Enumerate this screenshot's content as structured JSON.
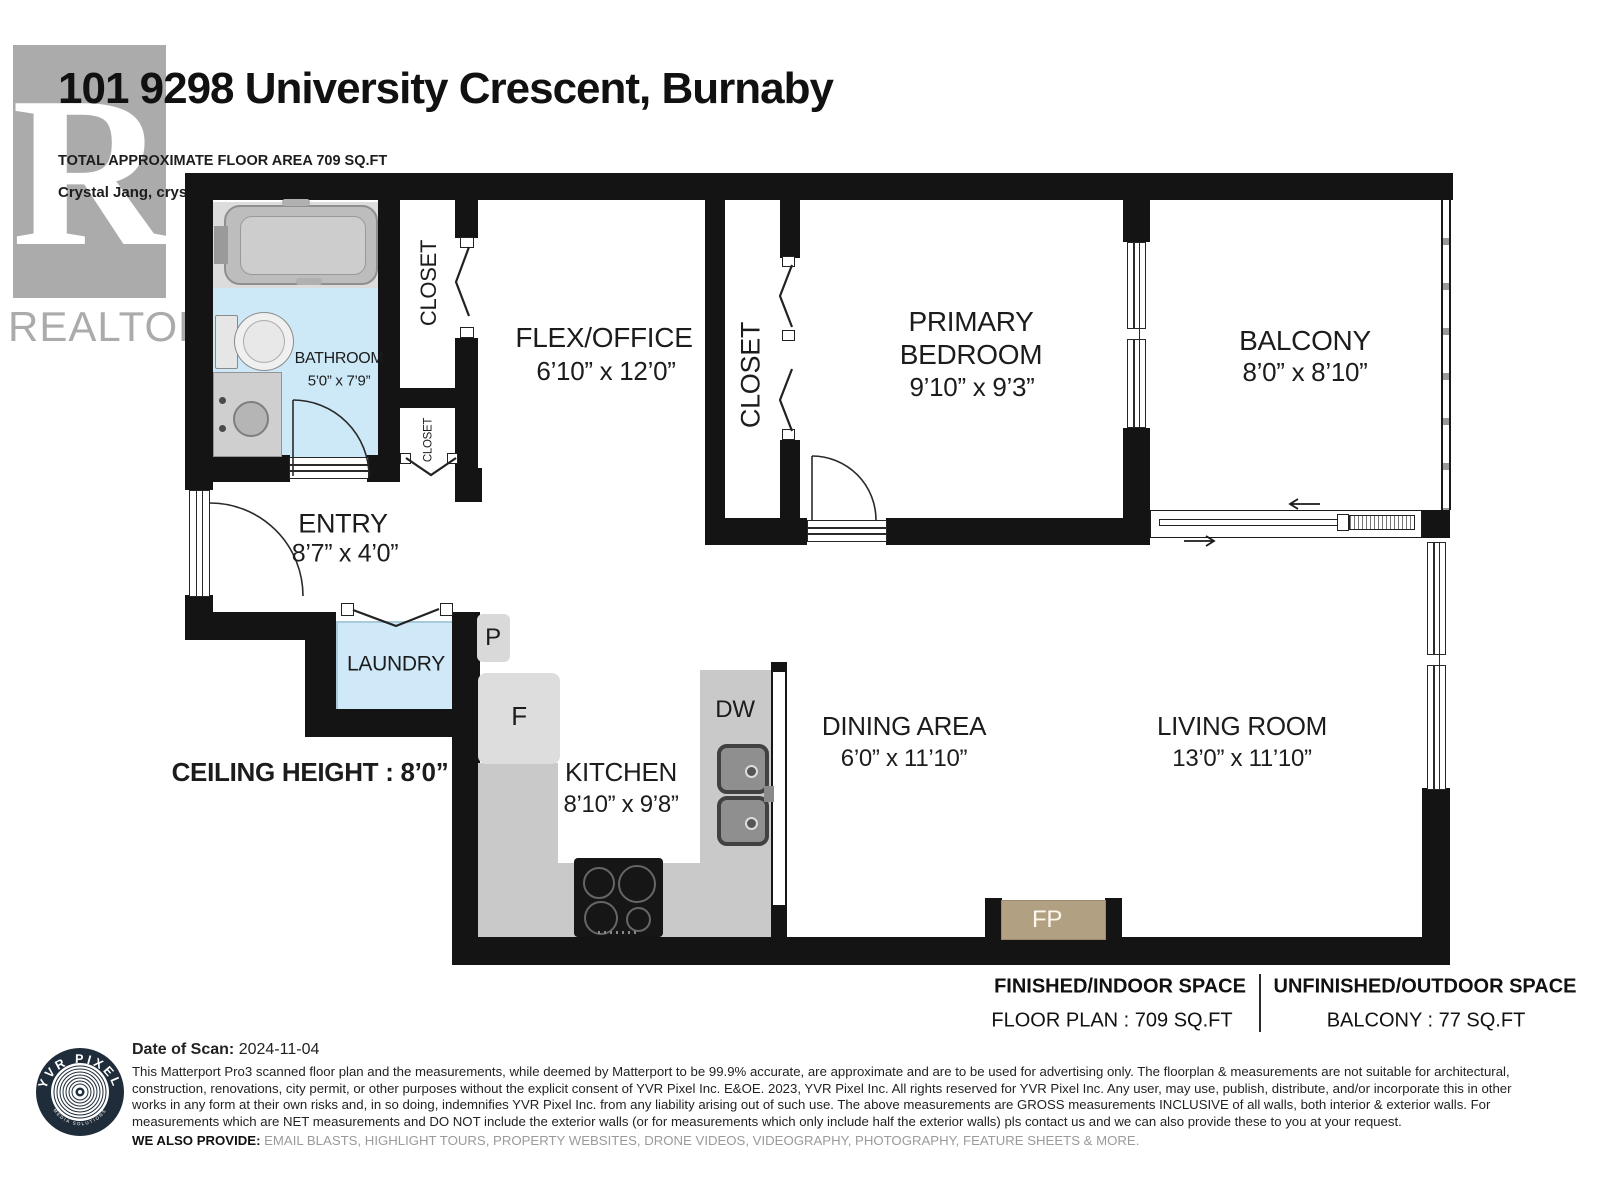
{
  "header": {
    "title": "101 9298 University Crescent, Burnaby",
    "subtitle": "TOTAL APPROXIMATE FLOOR AREA 709 SQ.FT",
    "contact": "Crystal Jang, crystalj.realty@gmail.com, 604-813-0836",
    "realtor_letter": "R",
    "realtor_text": "REALTOR",
    "realtor_reg": "®"
  },
  "rooms": {
    "bathroom": {
      "name": "BATHROOM",
      "dims": "5’0” x 7’9”"
    },
    "closet_upper": {
      "name": "CLOSET"
    },
    "closet_small": {
      "name": "CLOSET"
    },
    "flex_office": {
      "name": "FLEX/OFFICE",
      "dims": "6’10” x 12’0”"
    },
    "bedroom_closet": {
      "name": "CLOSET"
    },
    "primary_bedroom": {
      "line1": "PRIMARY",
      "line2": "BEDROOM",
      "dims": "9’10” x 9’3”"
    },
    "balcony": {
      "name": "BALCONY",
      "dims": "8’0” x 8’10”"
    },
    "entry": {
      "name": "ENTRY",
      "dims": "8’7” x 4’0”"
    },
    "laundry": {
      "name": "LAUNDRY"
    },
    "kitchen": {
      "name": "KITCHEN",
      "dims": "8’10” x 9’8”"
    },
    "dining": {
      "name": "DINING AREA",
      "dims": "6’0” x 11’10”"
    },
    "living": {
      "name": "LIVING ROOM",
      "dims": "13’0” x 11’10”"
    }
  },
  "fixtures": {
    "pantry": "P",
    "fridge": "F",
    "dishwasher": "DW",
    "fireplace": "FP"
  },
  "ceiling_note": "CEILING HEIGHT : 8’0”",
  "summary": {
    "finished_heading": "FINISHED/INDOOR SPACE",
    "finished_value": "FLOOR PLAN  :  709 SQ.FT",
    "unfinished_heading": "UNFINISHED/OUTDOOR SPACE",
    "unfinished_value": "BALCONY  :  77 SQ.FT"
  },
  "footer": {
    "scan_label": "Date of Scan:",
    "scan_date": "2024-11-04",
    "disclaimer": "This Matterport Pro3 scanned floor plan and the measurements, while deemed by Matterport to be 99.9% accurate, are approximate and are to be used for advertising only. The floorplan & measurements are not suitable for architectural, construction, renovations, city permit, or other purposes without the explicit consent of YVR Pixel Inc. E&OE. 2023, YVR Pixel Inc. All rights reserved for YVR Pixel Inc. Any user, may use, publish, distribute, and/or incorporate this in other works in any form at their own risks and, in so doing, indemnifies YVR Pixel Inc. from any liability arising out of such use. The above measurements are GROSS measurements INCLUSIVE of all walls, both interior & exterior walls. For measurements which are NET measurements and DO NOT include the exterior walls (or for measurements which only include half the exterior walls) pls contact us and we can also provide these to you at your request.",
    "provide_label": "WE ALSO PROVIDE:",
    "provide_list": "EMAIL BLASTS, HIGHLIGHT TOURS, PROPERTY WEBSITES, DRONE VIDEOS, VIDEOGRAPHY, PHOTOGRAPHY, FEATURE SHEETS & MORE.",
    "logo_text_top": "YVR PIXEL",
    "logo_text_bottom": "MEDIA SOLUTIONS"
  },
  "colors": {
    "wall": "#141414",
    "bathroom_floor": "#cde9f7",
    "laundry_floor": "#cfe9f8",
    "counter": "#c9c9c9",
    "fireplace": "#b2a083",
    "logo_navy": "#1f2d3a",
    "realtor_gray": "#ababab"
  }
}
